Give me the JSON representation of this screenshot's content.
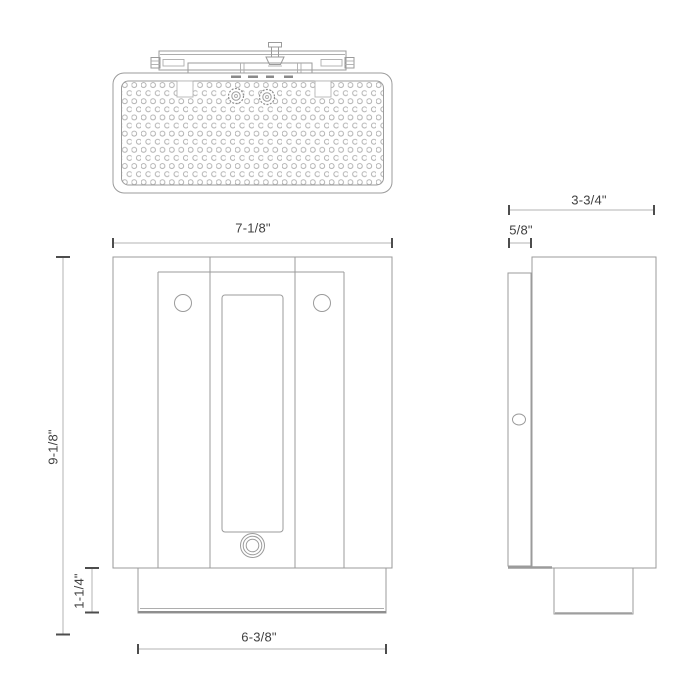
{
  "drawing": {
    "type": "product dimension drawing",
    "views": [
      "top",
      "front",
      "side"
    ]
  },
  "dims": {
    "overall_width": "7-1/8\"",
    "overall_height": "9-1/8\"",
    "base_height": "1-1/4\"",
    "base_width": "6-3/8\"",
    "overall_depth": "3-3/4\"",
    "backplate_depth": "5/8\""
  },
  "colors": {
    "background": "#ffffff",
    "outline": "#9b9b9b",
    "dimension_line": "#b3b3b3",
    "tick": "#4d4d4d",
    "text": "#3f3f3f"
  }
}
